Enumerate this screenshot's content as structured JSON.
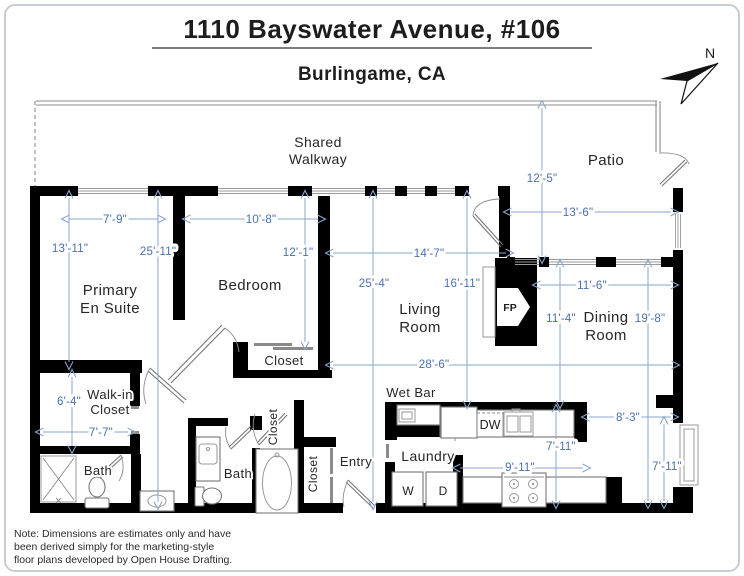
{
  "page": {
    "title": "1110 Bayswater Avenue, #106",
    "subtitle": "Burlingame, CA",
    "north_label": "N",
    "note_lines": [
      "Note: Dimensions are estimates only and have",
      "been derived simply for the marketing-style",
      "floor plans developed by Open House Drafting."
    ]
  },
  "colors": {
    "wall": "#000000",
    "dimension_text": "#4a70ad",
    "dimension_line": "#8aa4cb",
    "room_label": "#262626"
  },
  "floorplan": {
    "rooms": [
      {
        "id": "shared-walkway",
        "lines": [
          "Shared",
          "Walkway"
        ],
        "x": 318,
        "y": 147,
        "lh": 17,
        "size": 14
      },
      {
        "id": "patio",
        "lines": [
          "Patio"
        ],
        "x": 606,
        "y": 165,
        "size": 15
      },
      {
        "id": "primary-en-suite",
        "lines": [
          "Primary",
          "En Suite"
        ],
        "x": 110,
        "y": 295,
        "lh": 18,
        "size": 15
      },
      {
        "id": "bedroom",
        "lines": [
          "Bedroom"
        ],
        "x": 250,
        "y": 290,
        "size": 15
      },
      {
        "id": "bedroom-closet",
        "lines": [
          "Closet"
        ],
        "x": 284,
        "y": 365,
        "size": 13
      },
      {
        "id": "living-room",
        "lines": [
          "Living",
          "Room"
        ],
        "x": 420,
        "y": 314,
        "lh": 18,
        "size": 15
      },
      {
        "id": "dining-room",
        "lines": [
          "Dining",
          "Room"
        ],
        "x": 606,
        "y": 322,
        "lh": 18,
        "size": 15
      },
      {
        "id": "walk-in-closet",
        "lines": [
          "Walk-in",
          "Closet"
        ],
        "x": 110,
        "y": 399,
        "lh": 15,
        "size": 13
      },
      {
        "id": "bath-primary",
        "lines": [
          "Bath"
        ],
        "x": 98,
        "y": 475,
        "size": 13
      },
      {
        "id": "bath-hall",
        "lines": [
          "Bath"
        ],
        "x": 238,
        "y": 478,
        "size": 13
      },
      {
        "id": "linen-closet",
        "lines": [
          "Closet"
        ],
        "x": 277,
        "y": 427,
        "size": 12,
        "rot": -90
      },
      {
        "id": "entry-closet",
        "lines": [
          "Closet"
        ],
        "x": 317,
        "y": 474,
        "size": 12,
        "rot": -90
      },
      {
        "id": "entry",
        "lines": [
          "Entry"
        ],
        "x": 356,
        "y": 466,
        "size": 13
      },
      {
        "id": "laundry",
        "lines": [
          "Laundry"
        ],
        "x": 428,
        "y": 461,
        "size": 14
      },
      {
        "id": "wet-bar",
        "lines": [
          "Wet Bar"
        ],
        "x": 411,
        "y": 397,
        "size": 13
      }
    ],
    "fixture_labels": [
      {
        "id": "dishwasher",
        "label": "DW",
        "x": 490,
        "y": 429,
        "size": 12.5
      },
      {
        "id": "washer",
        "label": "W",
        "x": 408,
        "y": 495,
        "size": 12
      },
      {
        "id": "dryer",
        "label": "D",
        "x": 443,
        "y": 495,
        "size": 12
      },
      {
        "id": "fireplace",
        "label": "FP",
        "x": 510,
        "y": 311,
        "size": 10.5,
        "bold": true
      }
    ],
    "dims": [
      {
        "label": "7'-9\"",
        "line": [
          69,
          219,
          158,
          219
        ],
        "t": [
          115,
          219
        ]
      },
      {
        "label": "13'-11\"",
        "line": [
          69,
          198,
          69,
          362
        ],
        "t": [
          70,
          248
        ]
      },
      {
        "label": "25'-11\"",
        "line": [
          158,
          198,
          158,
          502
        ],
        "t": [
          158,
          251
        ]
      },
      {
        "label": "10'-8\"",
        "line": [
          190,
          219,
          318,
          219
        ],
        "t": [
          261,
          219
        ]
      },
      {
        "label": "12'-1\"",
        "line": [
          305,
          198,
          305,
          342
        ],
        "t": [
          298,
          252
        ]
      },
      {
        "label": "12'-5\"",
        "line": [
          542,
          108,
          542,
          256
        ],
        "t": [
          542,
          178
        ]
      },
      {
        "label": "13'-6\"",
        "line": [
          511,
          212,
          671,
          212
        ],
        "t": [
          578,
          212
        ]
      },
      {
        "label": "14'-7\"",
        "line": [
          333,
          253,
          506,
          253
        ],
        "t": [
          429,
          253
        ]
      },
      {
        "label": "25'-4\"",
        "line": [
          373,
          198,
          373,
          502
        ],
        "t": [
          374,
          283
        ]
      },
      {
        "label": "16'-11\"",
        "line": [
          467,
          198,
          467,
          401
        ],
        "t": [
          462,
          283
        ]
      },
      {
        "label": "11'-6\"",
        "line": [
          540,
          285,
          671,
          285
        ],
        "t": [
          592,
          285
        ]
      },
      {
        "label": "11'-4\"",
        "line": [
          560,
          267,
          560,
          401
        ],
        "t": [
          561,
          318
        ]
      },
      {
        "label": "19'-8\"",
        "line": [
          648,
          267,
          648,
          501
        ],
        "t": [
          650,
          318
        ]
      },
      {
        "label": "28'-6\"",
        "line": [
          333,
          365,
          672,
          365
        ],
        "t": [
          434,
          364
        ]
      },
      {
        "label": "6'-4\"",
        "line": [
          72,
          377,
          72,
          446
        ],
        "t": [
          69,
          401
        ]
      },
      {
        "label": "7'-7\"",
        "line": [
          43,
          432,
          128,
          432
        ],
        "t": [
          101,
          432
        ]
      },
      {
        "label": "8'-3\"",
        "line": [
          589,
          417,
          671,
          417
        ],
        "t": [
          628,
          417
        ]
      },
      {
        "label": "7'-11\"",
        "line": [
          556,
          412,
          556,
          501
        ],
        "t": [
          561,
          446
        ]
      },
      {
        "label": "7'-11\"",
        "line": [
          664,
          424,
          664,
          501
        ],
        "t": [
          667,
          466
        ]
      },
      {
        "label": "9'-11\"",
        "line": [
          460,
          468,
          583,
          468
        ],
        "t": [
          520,
          467
        ]
      }
    ]
  }
}
